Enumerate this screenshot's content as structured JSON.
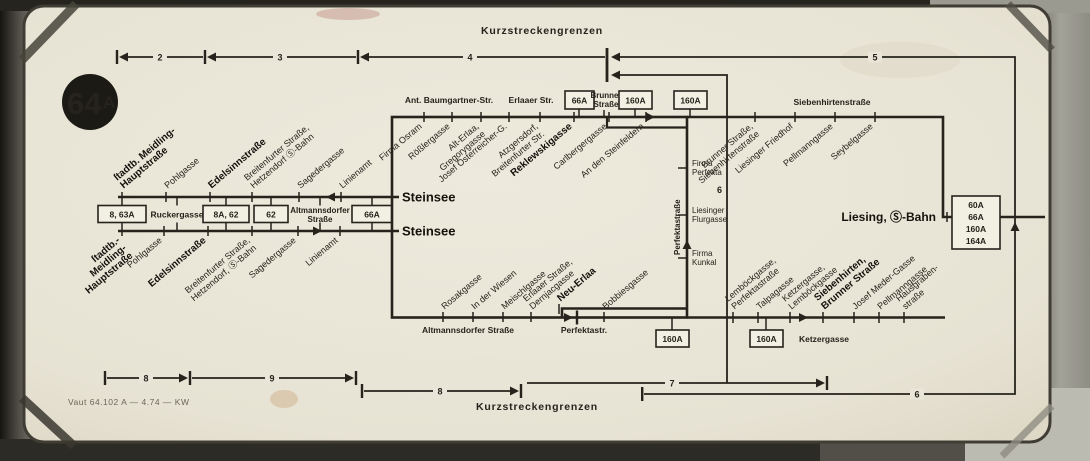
{
  "badge": {
    "main": "64",
    "suffix": "A"
  },
  "scales": {
    "top_title": "Kurzstreckengrenzen",
    "bottom_title": "Kurzstreckengrenzen",
    "top": {
      "n2": "2",
      "n3": "3",
      "n4": "4",
      "n5": "5"
    },
    "bottom": {
      "n8a": "8",
      "n9": "9",
      "n8b": "8",
      "n7": "7",
      "n6": "6",
      "n6v": "6"
    }
  },
  "imprint": "Vaut 64.102 A — 4.74 — KW",
  "left_route": {
    "upper": [
      {
        "l1": "ſtadtb. Meidling-",
        "l2": "Hauptstraße"
      },
      {
        "l1": "Pohlgasse"
      },
      {
        "l1": "Edelsinnstraße"
      },
      {
        "l1": "Breitenfurter Straße,",
        "l2": "Hetzendorf Ⓢ-Bahn"
      },
      {
        "l1": "Sagedergasse"
      },
      {
        "l1": "Linienamt"
      }
    ],
    "lower": [
      {
        "l1": "ſtadtb.-",
        "l2": "Meidling-",
        "l3": "Hauptstraße"
      },
      {
        "l1": "Pohlgasse"
      },
      {
        "l1": "Edelsinnstraße"
      },
      {
        "l1": "Breitenfurter Straße,",
        "l2": "Hetzendorf, Ⓢ-Bahn"
      },
      {
        "l1": "Sagedergasse"
      },
      {
        "l1": "Linienamt"
      }
    ],
    "boxes": {
      "b1": "8, 63A",
      "t1": "Ruckergasse",
      "b2": "8A, 62",
      "b3": "62",
      "t2a": "Altmannsdorfer",
      "t2b": "Straße",
      "b4": "66A"
    }
  },
  "loop": {
    "steinsee_upper": "Steinsee",
    "steinsee_lower": "Steinsee",
    "top": [
      {
        "l1": "Firma Osram"
      },
      {
        "l1": "Rößlergasse"
      },
      {
        "l1": "Alt-Erlaa,",
        "l2": "Gregorygasse"
      },
      {
        "l1": "Josef Österreicher-G."
      },
      {
        "l1": "Atzgersdorf,",
        "l2": "Breitenfurter Str."
      },
      {
        "l1": "Reklewskigasse"
      },
      {
        "l1": "Carlbergergasse"
      },
      {
        "l1": "An den Steinfeldern"
      }
    ],
    "bottom": [
      {
        "l1": "Rosakgasse"
      },
      {
        "l1": "In der Wiesen"
      },
      {
        "l1": "Meischlgasse"
      },
      {
        "l1": "Erlaaer Straße,",
        "l2": "Dernjacgasse"
      },
      {
        "l1": "Neu-Erlaa"
      },
      {
        "l1": "Bobbiesgasse"
      }
    ],
    "perfekta_street": "Perfektastraße",
    "east": [
      {
        "l1": "Firma",
        "l2": "Perfekta"
      },
      {
        "l1": "Liesinger",
        "l2": "Flurgasse"
      },
      {
        "l1": "Firma",
        "l2": "Kunkal"
      }
    ]
  },
  "north": {
    "ant_baumgartner": "Ant. Baumgartner-Str.",
    "erlaaer": "Erlaaer Str.",
    "b66a": "66A",
    "brunner_l1": "Brunner",
    "brunner_l2": "Straße",
    "b160a": "160A",
    "b160b": "160A",
    "siebenhirtenstrasse": "Siebenhirtenstraße",
    "diag": [
      {
        "l1": "Brunner Straße,",
        "l2": "Siebenhirtenstraße"
      },
      {
        "l1": "Liesinger Friedhof"
      },
      {
        "l1": "Pellmanngasse"
      },
      {
        "l1": "Seybelgasse"
      }
    ],
    "liesing": "Liesing, Ⓢ-Bahn",
    "terminal_box": [
      "60A",
      "66A",
      "160A",
      "164A"
    ]
  },
  "south": {
    "altmannsdorfer": "Altmannsdorfer Straße",
    "perfektastr": "Perfektastr.",
    "b160a": "160A",
    "b160b": "160A",
    "ketzergasse": "Ketzergasse",
    "diag": [
      {
        "l1": "Lemböckgasse,",
        "l2": "Perfektastraße"
      },
      {
        "l1": "Talpagasse"
      },
      {
        "l1": "Ketzergasse,",
        "l2": "Lemböckgasse"
      },
      {
        "l1": "Siebenhirten,",
        "l2": "Brunner Straße"
      },
      {
        "l1": "Josef Meder-Gasse"
      },
      {
        "l1": "Pellmanngasse"
      },
      {
        "l1": "Hausgraben-",
        "l2": "straße"
      }
    ]
  }
}
